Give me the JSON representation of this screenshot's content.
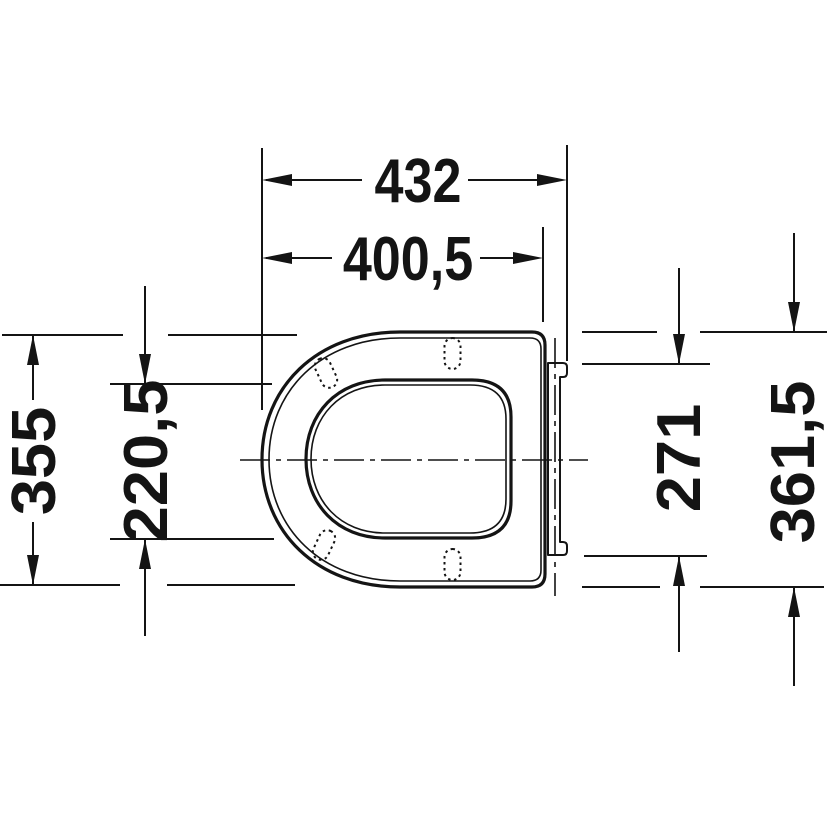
{
  "drawing": {
    "subject": "toilet-seat-top-view",
    "background_color": "#ffffff",
    "line_color": "#141414",
    "units_style": "millimeters-decimal-comma",
    "dimensions": {
      "overall_length": {
        "label": "432",
        "orientation": "horizontal"
      },
      "body_length": {
        "label": "400,5",
        "orientation": "horizontal"
      },
      "seat_width": {
        "label": "355",
        "orientation": "vertical"
      },
      "opening_width": {
        "label": "220,5",
        "orientation": "vertical"
      },
      "hinge_span": {
        "label": "271",
        "orientation": "vertical"
      },
      "lid_width": {
        "label": "361,5",
        "orientation": "vertical"
      }
    }
  }
}
